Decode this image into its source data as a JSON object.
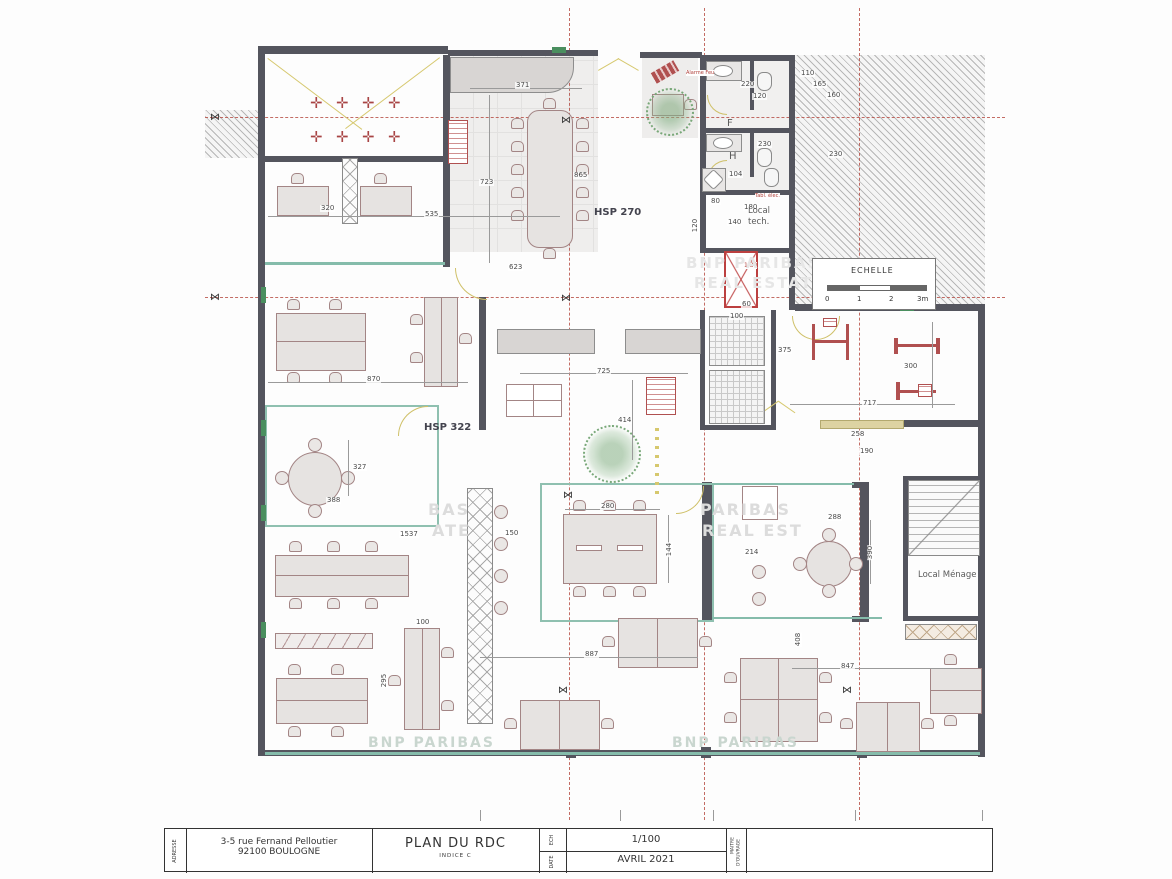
{
  "labels": {
    "hsp270": "HSP 270",
    "hsp322": "HSP 322",
    "local_tech_1": "Local",
    "local_tech_2": "tech.",
    "local_menage": "Local Ménage",
    "wc_f": "F",
    "wc_h": "H",
    "fire": "Alarme Feu",
    "gaine": "Tabl. élec.",
    "lift_dim": "1.30"
  },
  "scale_bar": {
    "title": "ECHELLE",
    "ticks": [
      "0",
      "1",
      "2",
      "3m"
    ]
  },
  "watermarks": {
    "w1a": "BNP PARIBAS",
    "w1b": "REAL ESTATE",
    "w2a": "BAS",
    "w2b": "ATE",
    "w3a": "PARIBAS",
    "w3b": "REAL EST",
    "w4": "BNP PARIBAS",
    "w5": "BNP PARIBAS"
  },
  "title_block": {
    "adresse_label": "ADRESSE",
    "address_line1": "3-5 rue Fernand Pelloutier",
    "address_line2": "92100 BOULOGNE",
    "plan_title": "PLAN DU RDC",
    "indice": "INDICE C",
    "ech_label": "ECH",
    "scale_value": "1/100",
    "date_label": "DATE",
    "date_value": "AVRIL 2021",
    "maitre_label_1": "MAITRE",
    "maitre_label_2": "D'OUVRAGE"
  },
  "dimensions": [
    {
      "t": "371"
    },
    {
      "t": "723"
    },
    {
      "t": "865"
    },
    {
      "t": "320"
    },
    {
      "t": "535"
    },
    {
      "t": "623"
    },
    {
      "t": "220"
    },
    {
      "t": "120"
    },
    {
      "t": "110"
    },
    {
      "t": "165"
    },
    {
      "t": "160"
    },
    {
      "t": "230"
    },
    {
      "t": "230"
    },
    {
      "t": "104"
    },
    {
      "t": "80"
    },
    {
      "t": "180"
    },
    {
      "t": "140"
    },
    {
      "t": "120"
    },
    {
      "t": "870"
    },
    {
      "t": "725"
    },
    {
      "t": "414"
    },
    {
      "t": "375"
    },
    {
      "t": "300"
    },
    {
      "t": "717"
    },
    {
      "t": "258"
    },
    {
      "t": "190"
    },
    {
      "t": "60"
    },
    {
      "t": "100"
    },
    {
      "t": "327"
    },
    {
      "t": "388"
    },
    {
      "t": "1537"
    },
    {
      "t": "150"
    },
    {
      "t": "280"
    },
    {
      "t": "144"
    },
    {
      "t": "887"
    },
    {
      "t": "408"
    },
    {
      "t": "288"
    },
    {
      "t": "390"
    },
    {
      "t": "214"
    },
    {
      "t": "847"
    },
    {
      "t": "100"
    },
    {
      "t": "295"
    }
  ]
}
